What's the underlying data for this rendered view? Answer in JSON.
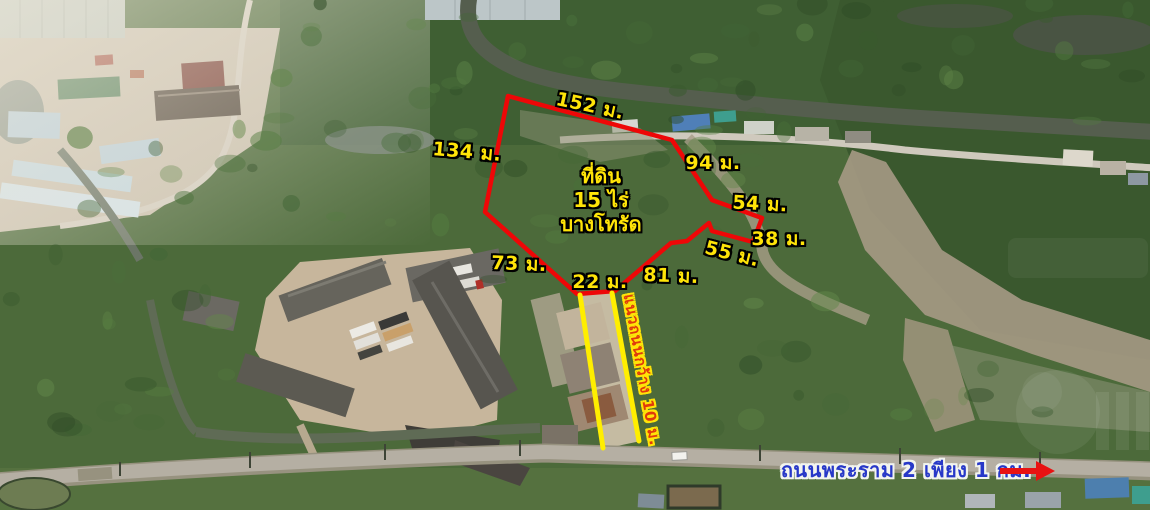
{
  "annotations": {
    "plot_label": {
      "line1": "ที่ดิน",
      "line2": "15 ไร่",
      "line3": "บางโทรัด"
    },
    "measurements": [
      {
        "side": "top",
        "text": "152 ม."
      },
      {
        "side": "left",
        "text": "134 ม."
      },
      {
        "side": "upper-right",
        "text": "94 ม."
      },
      {
        "side": "right-1",
        "text": "54 ม."
      },
      {
        "side": "right-2",
        "text": "38 ม."
      },
      {
        "side": "right-3",
        "text": "55 ม."
      },
      {
        "side": "bottom-right",
        "text": "81 ม."
      },
      {
        "side": "bottom-left",
        "text": "73 ม."
      },
      {
        "side": "frontage",
        "text": "22 ม."
      }
    ],
    "access_road_label": "แนวถนนกว้าง 10 ม.",
    "main_road_label": "ถนนพระราม 2 เพียง 1 กม."
  },
  "colors": {
    "boundary": "#ee0707",
    "measurement_text": "#ffe408",
    "access_road_lines": "#ffee00",
    "access_road_text": "#e03a0c",
    "main_road_text": "#2738c8",
    "arrow": "#e81212"
  }
}
